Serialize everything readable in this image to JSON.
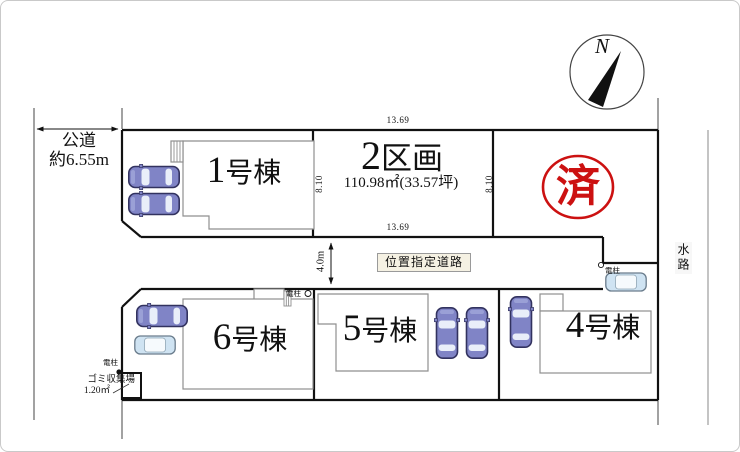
{
  "compass": {
    "label": "N"
  },
  "public_road": {
    "name": "公道",
    "width": "約6.55m"
  },
  "road": {
    "label": "位置指定道路",
    "width": "4.0m"
  },
  "waterway": {
    "label": "水路"
  },
  "lot2": {
    "number": "2",
    "suffix": "区画",
    "area": "110.98㎡(33.57坪)",
    "dim_top": "13.69",
    "dim_bottom": "13.69",
    "dim_left": "8.10",
    "dim_right": "8.10"
  },
  "sold_stamp": {
    "label": "済"
  },
  "buildings": {
    "b1": {
      "number": "1",
      "suffix": "号棟"
    },
    "b4": {
      "number": "4",
      "suffix": "号棟"
    },
    "b5": {
      "number": "5",
      "suffix": "号棟"
    },
    "b6": {
      "number": "6",
      "suffix": "号棟"
    }
  },
  "garbage_station": {
    "name": "ゴミ収集場",
    "size": "1.20㎡"
  },
  "utility_pole": {
    "label": "電柱"
  },
  "icons": {
    "north_needle": "black-triangle-needle",
    "utility_pole_dot": "filled-circle",
    "utility_pole_mark": "open-circle",
    "car": "top-view-car-shape"
  },
  "colors": {
    "car_blue": "#8084c6",
    "car_light": "#cfe3f2",
    "car_outline": "#32325f",
    "stamp_red": "#cc1111",
    "building_outline": "#8f8f8f",
    "boundary": "#111111"
  }
}
